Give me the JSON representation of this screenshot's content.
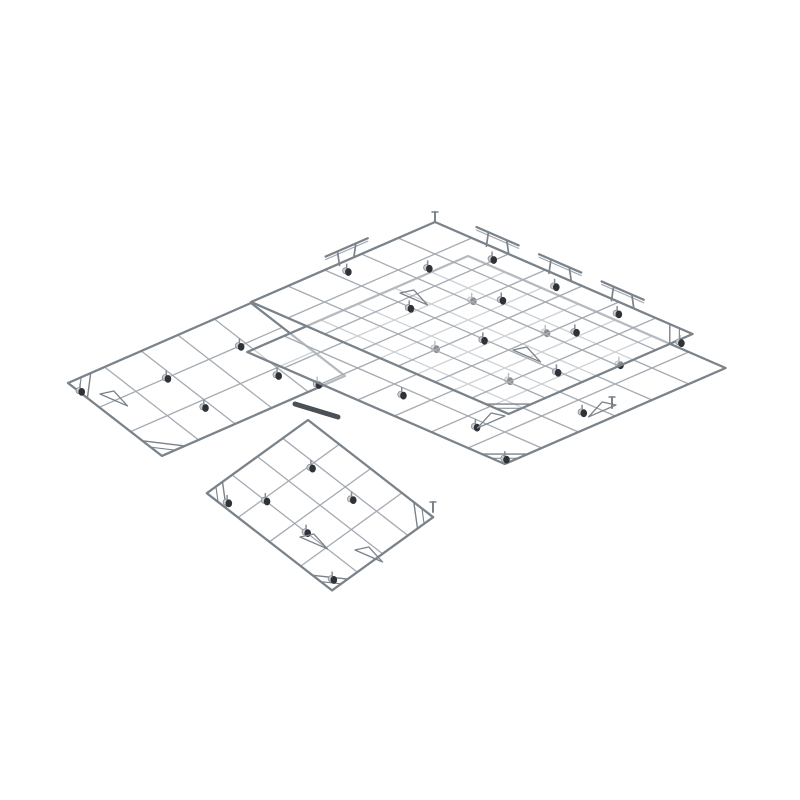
{
  "scene": {
    "canvas": {
      "width": 800,
      "height": 800
    },
    "background": "#ffffff",
    "colors": {
      "border": "#7a828a",
      "grid": "#a4abb2",
      "overlay": "rgba(255,255,255,0.45)",
      "bracket": "#7a828a",
      "wheel_dark": "#2f3337",
      "wheel_light": "#c9cdd2",
      "wheel_stroke": "#868c93",
      "connector": "#4b5056"
    },
    "iso_axes": {
      "u": [
        36.8,
        16
      ],
      "v": [
        -36.8,
        16
      ]
    },
    "panels": [
      {
        "name": "top",
        "origin": [
          435,
          222
        ],
        "axis_u": [
          36.8,
          16
        ],
        "axis_v": [
          -36.8,
          16
        ],
        "cols": 7,
        "rows": 5
      },
      {
        "name": "right",
        "origin": [
          468,
          256
        ],
        "axis_u": [
          36.8,
          16
        ],
        "axis_v": [
          -36.8,
          16
        ],
        "cols": 7,
        "rows": 6
      },
      {
        "name": "left",
        "origin": [
          251,
          303
        ],
        "axis_u": [
          31.3,
          24.3
        ],
        "axis_v": [
          -36.6,
          16
        ],
        "cols": 3,
        "rows": 5
      },
      {
        "name": "bottom",
        "origin": [
          308,
          420
        ],
        "axis_u": [
          31.3,
          24.3
        ],
        "axis_v": [
          -25.3,
          18.3
        ],
        "cols": 4,
        "rows": 4
      }
    ],
    "render_order": [
      3,
      2,
      1,
      0
    ],
    "stroke_widths": {
      "panel_border": 2.3,
      "panel_grid": 1.3
    },
    "casters": [
      {
        "p": 0,
        "u": 1.7,
        "v": 0.15
      },
      {
        "p": 0,
        "u": 3.4,
        "v": 0.15
      },
      {
        "p": 0,
        "u": 5.1,
        "v": 0.15
      },
      {
        "p": 0,
        "u": 6.85,
        "v": 0.2
      },
      {
        "p": 0,
        "u": 0.1,
        "v": 2.5
      },
      {
        "p": 0,
        "u": 1.1,
        "v": 1.3
      },
      {
        "p": 0,
        "u": 3.1,
        "v": 1.3
      },
      {
        "p": 0,
        "u": 5.1,
        "v": 1.3
      },
      {
        "p": 0,
        "u": 2.1,
        "v": 2.8
      },
      {
        "p": 0,
        "u": 4.1,
        "v": 2.8
      },
      {
        "p": 0,
        "u": 6.1,
        "v": 2.8
      },
      {
        "p": 1,
        "u": 1.2,
        "v": 1.1
      },
      {
        "p": 1,
        "u": 3.2,
        "v": 1.1
      },
      {
        "p": 1,
        "u": 5.2,
        "v": 1.1
      },
      {
        "p": 1,
        "u": 2.2,
        "v": 3.1
      },
      {
        "p": 1,
        "u": 4.2,
        "v": 3.1
      },
      {
        "p": 1,
        "u": 6.2,
        "v": 3.1
      },
      {
        "p": 1,
        "u": 3.2,
        "v": 5.0
      },
      {
        "p": 1,
        "u": 5.2,
        "v": 5.0
      },
      {
        "p": 1,
        "u": 6.6,
        "v": 5.6
      },
      {
        "p": 2,
        "u": 0.8,
        "v": 1.0
      },
      {
        "p": 2,
        "u": 2.0,
        "v": 1.0
      },
      {
        "p": 2,
        "u": 2.7,
        "v": 0.5
      },
      {
        "p": 2,
        "u": 0.8,
        "v": 3.0
      },
      {
        "p": 2,
        "u": 2.0,
        "v": 3.0
      },
      {
        "p": 2,
        "u": 0.15,
        "v": 4.8
      },
      {
        "p": 3,
        "u": 0.9,
        "v": 1.0
      },
      {
        "p": 3,
        "u": 2.2,
        "v": 1.0
      },
      {
        "p": 3,
        "u": 0.9,
        "v": 2.8
      },
      {
        "p": 3,
        "u": 2.2,
        "v": 2.8
      },
      {
        "p": 3,
        "u": 0.35,
        "v": 3.63
      },
      {
        "p": 3,
        "u": 3.6,
        "v": 3.5
      }
    ],
    "handles": [
      {
        "p": 0,
        "edge": "u",
        "at": 1.7
      },
      {
        "p": 0,
        "edge": "u",
        "at": 3.4
      },
      {
        "p": 0,
        "edge": "u",
        "at": 5.1
      },
      {
        "p": 0,
        "edge": "v",
        "at": 2.4
      }
    ],
    "handle_style": {
      "bar_len": 46,
      "bar_rise": 13,
      "post_inset": 10
    },
    "gussets": [
      {
        "p": 0,
        "c": "right"
      },
      {
        "p": 0,
        "c": "bottom"
      },
      {
        "p": 1,
        "c": "bottom"
      },
      {
        "p": 2,
        "c": "left"
      },
      {
        "p": 2,
        "c": "bottom"
      },
      {
        "p": 3,
        "c": "left"
      },
      {
        "p": 3,
        "c": "bottom"
      },
      {
        "p": 3,
        "c": "right"
      }
    ],
    "braces": [
      {
        "x": 400,
        "y": 293,
        "axis": "u"
      },
      {
        "x": 513,
        "y": 350,
        "axis": "u"
      },
      {
        "x": 616,
        "y": 405,
        "axis": "v"
      },
      {
        "x": 505,
        "y": 416,
        "axis": "v"
      },
      {
        "x": 355,
        "y": 550,
        "axis": "u"
      },
      {
        "x": 100,
        "y": 394,
        "axis": "u"
      },
      {
        "x": 300,
        "y": 537,
        "axis": "u"
      }
    ],
    "connectors": [
      {
        "x1": 295,
        "y1": 404,
        "x2": 338,
        "y2": 417
      }
    ],
    "posts": [
      {
        "x": 435,
        "y": 222,
        "h": 10
      },
      {
        "x": 612,
        "y": 408,
        "h": 11
      },
      {
        "x": 433,
        "y": 512,
        "h": 10
      }
    ]
  }
}
